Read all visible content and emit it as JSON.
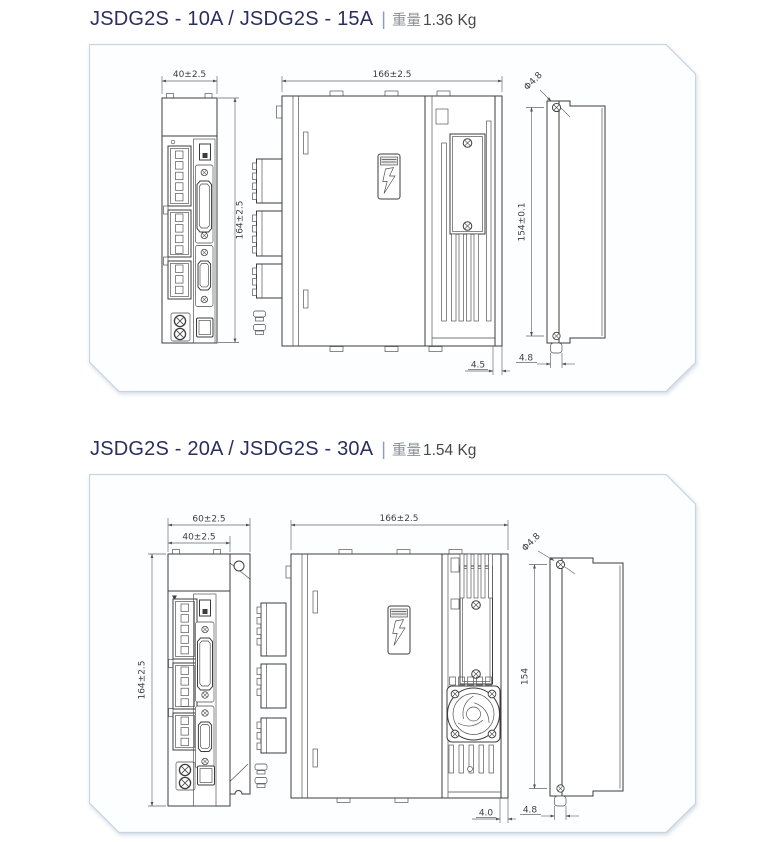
{
  "colors": {
    "title_accent": "#2b2e5e",
    "panel_border": "#c8d4e0",
    "drawing_line": "#3c3c3c",
    "dimension_line": "#666666"
  },
  "sections": [
    {
      "model_title": "JSDG2S - 10A / JSDG2S - 15A",
      "separator": "|",
      "weight_label": "重量",
      "weight_value": "1.36 Kg",
      "dimensions": {
        "front_width": "40±2.5",
        "front_height": "164±2.5",
        "side_depth": "166±2.5",
        "side_bottom_offset": "4.5",
        "rear_hole_dia": "Φ4.8",
        "rear_hole_pitch": "154±0.1",
        "rear_tab_width": "4.8"
      }
    },
    {
      "model_title": "JSDG2S - 20A / JSDG2S - 30A",
      "separator": "|",
      "weight_label": "重量",
      "weight_value": "1.54 Kg",
      "dimensions": {
        "front_outer_width": "60±2.5",
        "front_width": "40±2.5",
        "front_height": "164±2.5",
        "side_depth": "166±2.5",
        "side_bottom_offset": "4.0",
        "rear_hole_dia": "Φ4.8",
        "rear_hole_pitch": "154",
        "rear_tab_width": "4.8"
      }
    }
  ]
}
